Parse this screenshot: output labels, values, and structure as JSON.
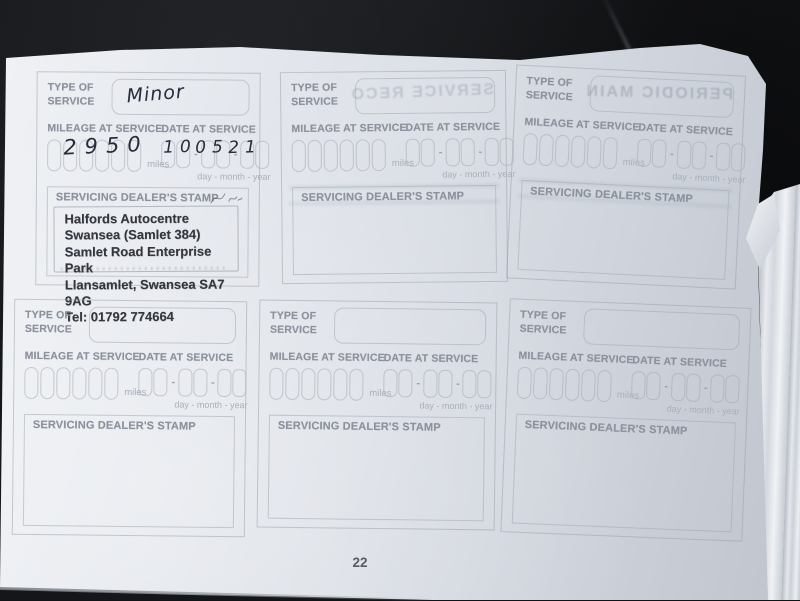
{
  "labels": {
    "type_of_service": "TYPE OF SERVICE",
    "mileage_at_service": "MILEAGE AT SERVICE",
    "miles_unit": "miles",
    "date_at_service": "DATE AT SERVICE",
    "date_format_hint": "day - month - year",
    "dealer_stamp": "SERVICING DEALER'S STAMP",
    "date_separator": "-"
  },
  "page_number": "22",
  "entries": [
    {
      "type_of_service": "Minor",
      "mileage": "2950",
      "date_day": "10",
      "date_month": "05",
      "date_year": "21",
      "stamp": {
        "line1": "Halfords Autocentre",
        "line2": "Swansea (Samlet 384)",
        "line3": "Samlet Road Enterprise Park",
        "line4": "Llansamlet, Swansea SA7 9AG",
        "line5": "Tel: 01792 774664"
      }
    },
    {
      "type_of_service": "",
      "mileage": "",
      "date_day": "",
      "date_month": "",
      "date_year": ""
    },
    {
      "type_of_service": "",
      "mileage": "",
      "date_day": "",
      "date_month": "",
      "date_year": ""
    },
    {
      "type_of_service": "",
      "mileage": "",
      "date_day": "",
      "date_month": "",
      "date_year": ""
    },
    {
      "type_of_service": "",
      "mileage": "",
      "date_day": "",
      "date_month": "",
      "date_year": ""
    },
    {
      "type_of_service": "",
      "mileage": "",
      "date_day": "",
      "date_month": "",
      "date_year": ""
    }
  ],
  "ghost_showthrough": {
    "middle_top_box": "SERVICE RECO",
    "right_top_box": "PERIODIC MAIN"
  },
  "colors": {
    "paper": "#dfe3ea",
    "print_gray": "#8c929d",
    "handwriting_ink": "#262c3a",
    "stamp_ink": "#33363d",
    "background_leather": "#151619"
  }
}
